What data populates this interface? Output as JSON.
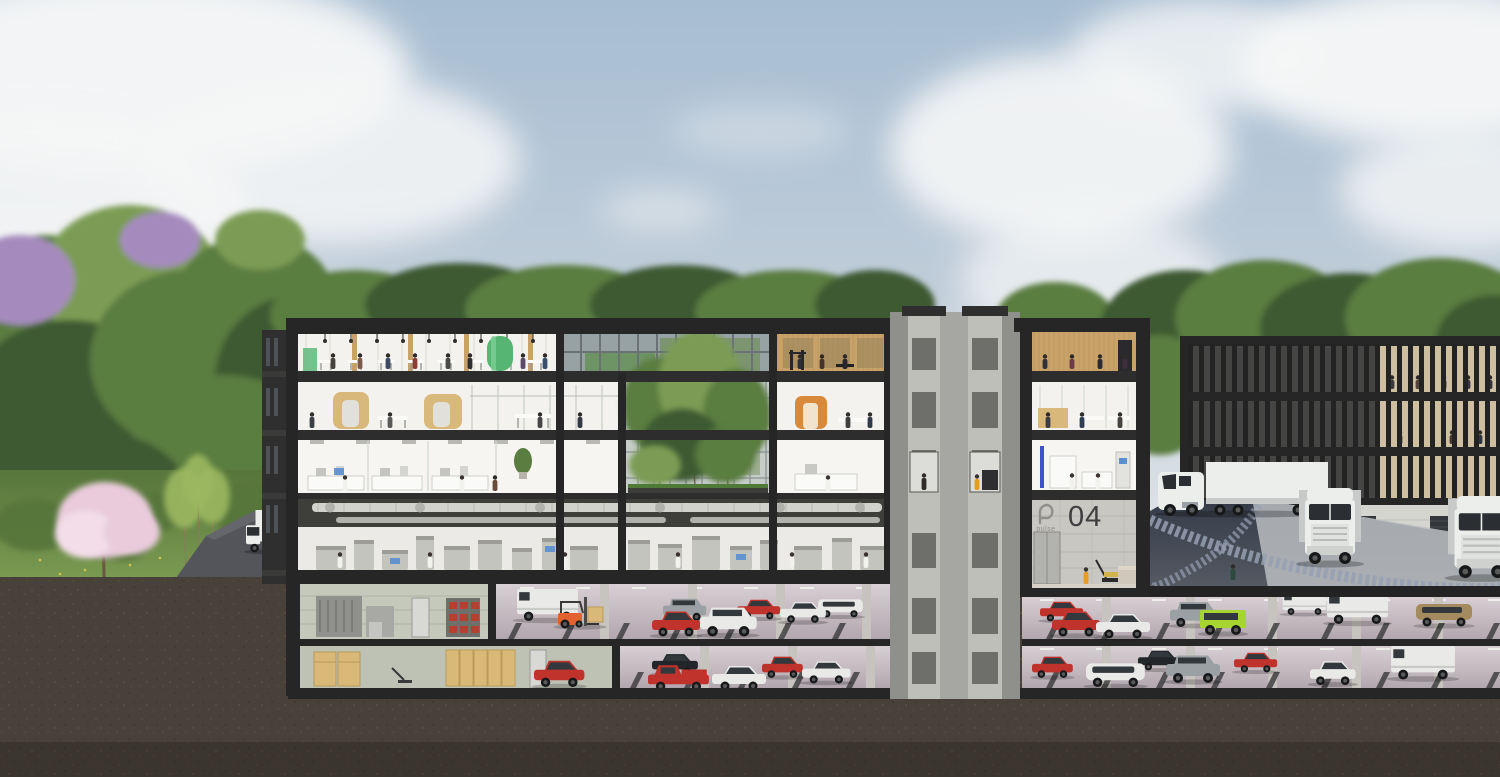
{
  "labels": {
    "building_number": "04",
    "brand_logo": "pulse"
  },
  "palette": {
    "sky_top": "#a7bdd2",
    "sky_mid": "#c3cfda",
    "sky_low": "#e8ebec",
    "cloud": "#f6f7f7",
    "tree_dark": "#3e5a32",
    "tree_mid": "#5a7d41",
    "tree_light": "#7c9c54",
    "lilac": "#a58bbd",
    "blossom": "#e9cbdb",
    "blossom_light": "#f2dde8",
    "sapling": "#9cb861",
    "grass": "#6e8f4a",
    "grass_dark": "#57763b",
    "flower": "#d8c84a",
    "earth": "#48413a",
    "frame": "#262626",
    "slab": "#2d2d2d",
    "concrete": "#a6a6a2",
    "concrete_dark": "#8f8f8b",
    "concrete_light": "#bfbfba",
    "interior": "#f3f2ee",
    "interior_dim": "#e2e0da",
    "ceiling": "#e8e4dc",
    "glass": "#b9c3c5",
    "glass_dark": "#97a2a4",
    "wood": "#c8a269",
    "wood_dark": "#a9854b",
    "pod_wood": "#d9b87c",
    "green_accent": "#56b573",
    "orange_accent": "#d8893c",
    "blue_led": "#3d52c9",
    "screen_blue": "#5a8fd0",
    "duct": "#d2d2cd",
    "duct_dark": "#b2b2ad",
    "duct_bg": "#3e3e3b",
    "machine": "#c4c4bf",
    "machine_dark": "#9d9d98",
    "asphalt": "#53555b",
    "asphalt_dark": "#3a414e",
    "cobble": "#95a0b2",
    "apron": "#babdc1",
    "stall": "#38383a",
    "pillar": "#c7c3bf",
    "wall_tile": "#c5c9bb",
    "cabinet": "#90908c",
    "box_tan": "#d9b878",
    "bin_red": "#b5402f",
    "red": "#c0332d",
    "white": "#e9eae7",
    "gray": "#9aa0a4",
    "black": "#22262a",
    "lime": "#a6d52f",
    "tan": "#a38a5f",
    "forklift": "#e2612f",
    "hivis": "#e89b1e",
    "truck_white": "#eceeec",
    "truck_shadow": "#c7cac9",
    "dark_glass": "#2b2e33",
    "lobby_wall": "#c9c7c1",
    "logo_gray": "#8f8f8a",
    "number_dark": "#3e3e3e"
  },
  "clouds": [
    {
      "cx": 140,
      "cy": 70,
      "rx": 270,
      "ry": 100,
      "o": 0.95
    },
    {
      "cx": 40,
      "cy": 230,
      "rx": 210,
      "ry": 120,
      "o": 0.9
    },
    {
      "cx": 330,
      "cy": 160,
      "rx": 190,
      "ry": 85,
      "o": 0.85
    },
    {
      "cx": 250,
      "cy": 330,
      "rx": 150,
      "ry": 60,
      "o": 0.5
    },
    {
      "cx": 660,
      "cy": 210,
      "rx": 60,
      "ry": 20,
      "o": 0.5
    },
    {
      "cx": 760,
      "cy": 130,
      "rx": 90,
      "ry": 26,
      "o": 0.35
    },
    {
      "cx": 1060,
      "cy": 150,
      "rx": 170,
      "ry": 95,
      "o": 0.9
    },
    {
      "cx": 1090,
      "cy": 280,
      "rx": 130,
      "ry": 65,
      "o": 0.7
    },
    {
      "cx": 1000,
      "cy": 360,
      "rx": 110,
      "ry": 40,
      "o": 0.5
    },
    {
      "cx": 1200,
      "cy": 55,
      "rx": 130,
      "ry": 55,
      "o": 0.8
    },
    {
      "cx": 1430,
      "cy": 65,
      "rx": 190,
      "ry": 80,
      "o": 0.95
    },
    {
      "cx": 1470,
      "cy": 190,
      "rx": 130,
      "ry": 60,
      "o": 0.8
    }
  ],
  "forest": [
    {
      "cx": 45,
      "cy": 330,
      "rx": 95,
      "ry": 95,
      "c": "tree_mid"
    },
    {
      "cx": 130,
      "cy": 280,
      "rx": 90,
      "ry": 75,
      "c": "tree_light"
    },
    {
      "cx": 70,
      "cy": 420,
      "rx": 110,
      "ry": 100,
      "c": "tree_dark"
    },
    {
      "cx": 190,
      "cy": 360,
      "rx": 100,
      "ry": 90,
      "c": "tree_mid"
    },
    {
      "cx": 255,
      "cy": 300,
      "rx": 80,
      "ry": 65,
      "c": "tree_mid"
    },
    {
      "cx": 300,
      "cy": 380,
      "rx": 85,
      "ry": 85,
      "c": "tree_dark"
    },
    {
      "cx": 225,
      "cy": 450,
      "rx": 95,
      "ry": 75,
      "c": "tree_mid"
    },
    {
      "cx": 90,
      "cy": 500,
      "rx": 100,
      "ry": 70,
      "c": "tree_dark"
    },
    {
      "cx": 20,
      "cy": 280,
      "rx": 55,
      "ry": 45,
      "c": "lilac"
    },
    {
      "cx": 160,
      "cy": 240,
      "rx": 40,
      "ry": 28,
      "c": "lilac"
    },
    {
      "cx": 260,
      "cy": 240,
      "rx": 45,
      "ry": 30,
      "c": "tree_light"
    },
    {
      "cx": 355,
      "cy": 315,
      "rx": 85,
      "ry": 45,
      "c": "tree_mid"
    },
    {
      "cx": 460,
      "cy": 305,
      "rx": 95,
      "ry": 42,
      "c": "tree_dark"
    },
    {
      "cx": 565,
      "cy": 310,
      "rx": 100,
      "ry": 45,
      "c": "tree_mid"
    },
    {
      "cx": 680,
      "cy": 305,
      "rx": 90,
      "ry": 40,
      "c": "tree_dark"
    },
    {
      "cx": 790,
      "cy": 312,
      "rx": 95,
      "ry": 42,
      "c": "tree_mid"
    },
    {
      "cx": 875,
      "cy": 305,
      "rx": 60,
      "ry": 35,
      "c": "tree_dark"
    },
    {
      "cx": 1055,
      "cy": 320,
      "rx": 60,
      "ry": 38,
      "c": "tree_mid"
    },
    {
      "cx": 1185,
      "cy": 330,
      "rx": 85,
      "ry": 60,
      "c": "tree_dark"
    },
    {
      "cx": 1265,
      "cy": 318,
      "rx": 90,
      "ry": 58,
      "c": "tree_mid"
    },
    {
      "cx": 1350,
      "cy": 328,
      "rx": 90,
      "ry": 55,
      "c": "tree_dark"
    },
    {
      "cx": 1440,
      "cy": 318,
      "rx": 95,
      "ry": 60,
      "c": "tree_mid"
    },
    {
      "cx": 1495,
      "cy": 345,
      "rx": 60,
      "ry": 50,
      "c": "tree_dark"
    },
    {
      "cx": 1160,
      "cy": 395,
      "rx": 55,
      "ry": 60,
      "c": "tree_mid"
    }
  ],
  "bushes": [
    {
      "cx": 35,
      "cy": 525,
      "rx": 42,
      "ry": 26
    },
    {
      "cx": 150,
      "cy": 512,
      "rx": 36,
      "ry": 20
    },
    {
      "cx": 252,
      "cy": 508,
      "rx": 46,
      "ry": 28
    },
    {
      "cx": 305,
      "cy": 525,
      "rx": 40,
      "ry": 24
    },
    {
      "cx": 120,
      "cy": 545,
      "rx": 30,
      "ry": 16
    }
  ],
  "flowers": [
    [
      40,
      560
    ],
    [
      85,
      570
    ],
    [
      130,
      565
    ],
    [
      200,
      572
    ],
    [
      240,
      566
    ],
    [
      60,
      574
    ],
    [
      160,
      558
    ],
    [
      275,
      560
    ]
  ],
  "courtyard_trees": [
    {
      "cx": 660,
      "cy": 405,
      "rx": 38,
      "ry": 48,
      "c": "tree_mid"
    },
    {
      "cx": 700,
      "cy": 385,
      "rx": 42,
      "ry": 55,
      "c": "tree_light"
    },
    {
      "cx": 737,
      "cy": 415,
      "rx": 34,
      "ry": 46,
      "c": "tree_mid"
    },
    {
      "cx": 682,
      "cy": 445,
      "rx": 40,
      "ry": 36,
      "c": "tree_dark"
    },
    {
      "cx": 725,
      "cy": 455,
      "rx": 30,
      "ry": 28,
      "c": "tree_mid"
    },
    {
      "cx": 655,
      "cy": 465,
      "rx": 26,
      "ry": 20,
      "c": "tree_light"
    }
  ],
  "people": {
    "cafeteria": [
      [
        333,
        "#45423e"
      ],
      [
        360,
        "#7c5a49"
      ],
      [
        388,
        "#3c4a62"
      ],
      [
        415,
        "#8a3e36"
      ],
      [
        448,
        "#4a4a48"
      ],
      [
        470,
        "#2e2e2e"
      ],
      [
        523,
        "#5d4a6a"
      ],
      [
        545,
        "#37506b"
      ]
    ],
    "gym_left": [
      [
        800,
        "#2c2c34"
      ],
      [
        822,
        "#44342c"
      ],
      [
        845,
        "#25252b"
      ]
    ],
    "office_left": [
      [
        312,
        "#3a3e46"
      ],
      [
        390,
        "#5a5a58"
      ],
      [
        540,
        "#454545"
      ],
      [
        580,
        "#333a44"
      ]
    ],
    "office_right": [
      [
        848,
        "#3e3e3e"
      ],
      [
        870,
        "#2f3a4a"
      ]
    ],
    "lab_left": [
      [
        345,
        "coat"
      ],
      [
        462,
        "coat"
      ],
      [
        495,
        "#6b4a3a"
      ]
    ],
    "lab_right": [
      [
        828,
        "coat"
      ]
    ],
    "production": [
      [
        340,
        "coat"
      ],
      [
        430,
        "coat"
      ],
      [
        565,
        "coat"
      ],
      [
        678,
        "coat"
      ],
      [
        792,
        "coat"
      ],
      [
        866,
        "coat"
      ]
    ],
    "wing_gym": [
      [
        1045,
        "#32323a"
      ],
      [
        1072,
        "#6a3a4a"
      ],
      [
        1100,
        "#2a2a30"
      ],
      [
        1125,
        "#3e2e3e"
      ]
    ],
    "wing_office": [
      [
        1048,
        "#3c3c44"
      ],
      [
        1082,
        "#2e3e52"
      ],
      [
        1120,
        "#46423e"
      ]
    ],
    "wing_lab": [
      [
        1072,
        "coat"
      ],
      [
        1098,
        "coat"
      ]
    ],
    "bench": [
      [
        500,
        "#b04a3c"
      ],
      [
        552,
        "#3a4a5c"
      ],
      [
        564,
        "#2e2e34"
      ]
    ],
    "road_left": [
      [
        297,
        "#8a8a88"
      ]
    ],
    "road_right": [
      [
        1233,
        "#2e4a3e"
      ]
    ]
  },
  "rb_people1": [
    [
      1392,
      "#3a3a3e"
    ],
    [
      1418,
      "#54433a"
    ],
    [
      1444,
      "#2e2e34"
    ],
    [
      1468,
      "#3e3546"
    ],
    [
      1490,
      "#33333b"
    ]
  ],
  "rb_people2": [
    [
      1400,
      "#3a3a40"
    ],
    [
      1452,
      "#4a3a32"
    ],
    [
      1480,
      "#2e3440"
    ]
  ],
  "machines": [
    [
      316,
      30,
      24
    ],
    [
      354,
      20,
      30
    ],
    [
      382,
      26,
      20
    ],
    [
      416,
      18,
      34
    ],
    [
      444,
      26,
      24
    ],
    [
      478,
      24,
      30
    ],
    [
      512,
      20,
      22
    ],
    [
      542,
      16,
      32
    ],
    [
      570,
      28,
      24
    ],
    [
      628,
      22,
      30
    ],
    [
      658,
      24,
      26
    ],
    [
      692,
      28,
      34
    ],
    [
      730,
      22,
      24
    ],
    [
      760,
      18,
      30
    ],
    [
      794,
      28,
      24
    ],
    [
      832,
      20,
      32
    ],
    [
      860,
      24,
      24
    ]
  ],
  "pillars": {
    "b1": [
      600,
      688,
      776,
      862
    ],
    "b2": [
      700,
      788,
      866
    ],
    "p1": [
      1102,
      1186,
      1268,
      1352,
      1434
    ],
    "p2": [
      1102,
      1186,
      1268,
      1352,
      1434
    ]
  },
  "cars": {
    "b1": [
      {
        "t": "van",
        "x": 516,
        "y": 589,
        "s": 1.05,
        "c": "white"
      },
      {
        "t": "forklift",
        "x": 556,
        "y": 597,
        "s": 1,
        "c": "forklift"
      },
      {
        "t": "suv",
        "x": 663,
        "y": 596,
        "s": 0.8,
        "c": "gray"
      },
      {
        "t": "sedan",
        "x": 737,
        "y": 595,
        "s": 0.8,
        "c": "red"
      },
      {
        "t": "minivan",
        "x": 818,
        "y": 593,
        "s": 0.8,
        "c": "white"
      },
      {
        "t": "hatch",
        "x": 652,
        "y": 606,
        "s": 1,
        "c": "red"
      },
      {
        "t": "suv",
        "x": 700,
        "y": 604,
        "s": 1.05,
        "c": "white"
      },
      {
        "t": "sedan",
        "x": 780,
        "y": 597,
        "s": 0.85,
        "c": "white"
      }
    ],
    "b2": [
      {
        "t": "sedan",
        "x": 652,
        "y": 649,
        "s": 0.85,
        "c": "black"
      },
      {
        "t": "hatch",
        "x": 762,
        "y": 652,
        "s": 0.85,
        "c": "red"
      },
      {
        "t": "hatch",
        "x": 534,
        "y": 655,
        "s": 1.05,
        "c": "red"
      },
      {
        "t": "pickup",
        "x": 648,
        "y": 659,
        "s": 1.05,
        "c": "red"
      },
      {
        "t": "sedan",
        "x": 712,
        "y": 660,
        "s": 1,
        "c": "white"
      },
      {
        "t": "sedan",
        "x": 802,
        "y": 656,
        "s": 0.9,
        "c": "white"
      }
    ],
    "p1": [
      {
        "t": "sedan",
        "x": 1040,
        "y": 597,
        "s": 0.8,
        "c": "red"
      },
      {
        "t": "van",
        "x": 1282,
        "y": 592,
        "s": 0.75,
        "c": "white"
      },
      {
        "t": "suv",
        "x": 1170,
        "y": 599,
        "s": 0.9,
        "c": "gray"
      },
      {
        "t": "minivan",
        "x": 1416,
        "y": 596,
        "s": 1,
        "c": "tan"
      },
      {
        "t": "hatch",
        "x": 1052,
        "y": 606,
        "s": 1,
        "c": "red"
      },
      {
        "t": "sedan",
        "x": 1096,
        "y": 608,
        "s": 1,
        "c": "white"
      },
      {
        "t": "jimny",
        "x": 1200,
        "y": 604,
        "s": 1,
        "c": "lime"
      },
      {
        "t": "van",
        "x": 1326,
        "y": 592,
        "s": 1.05,
        "c": "white"
      }
    ],
    "p2": [
      {
        "t": "sedan",
        "x": 1138,
        "y": 646,
        "s": 0.8,
        "c": "black"
      },
      {
        "t": "sedan",
        "x": 1234,
        "y": 648,
        "s": 0.8,
        "c": "red"
      },
      {
        "t": "hatch",
        "x": 1032,
        "y": 652,
        "s": 0.85,
        "c": "red"
      },
      {
        "t": "minivan",
        "x": 1086,
        "y": 655,
        "s": 1.05,
        "c": "white"
      },
      {
        "t": "suv",
        "x": 1166,
        "y": 652,
        "s": 1,
        "c": "gray"
      },
      {
        "t": "hatch",
        "x": 1310,
        "y": 656,
        "s": 0.95,
        "c": "white"
      },
      {
        "t": "van",
        "x": 1390,
        "y": 646,
        "s": 1.1,
        "c": "white"
      }
    ]
  },
  "trucks": [
    {
      "kind": "box",
      "x": 246,
      "y": 510,
      "s": 0.95
    },
    {
      "kind": "semi_side",
      "x": 1158,
      "y": 462,
      "s": 1
    },
    {
      "kind": "semi_front",
      "x": 1299,
      "y": 488,
      "s": 1
    },
    {
      "kind": "semi_front",
      "x": 1448,
      "y": 496,
      "s": 1.08
    }
  ]
}
